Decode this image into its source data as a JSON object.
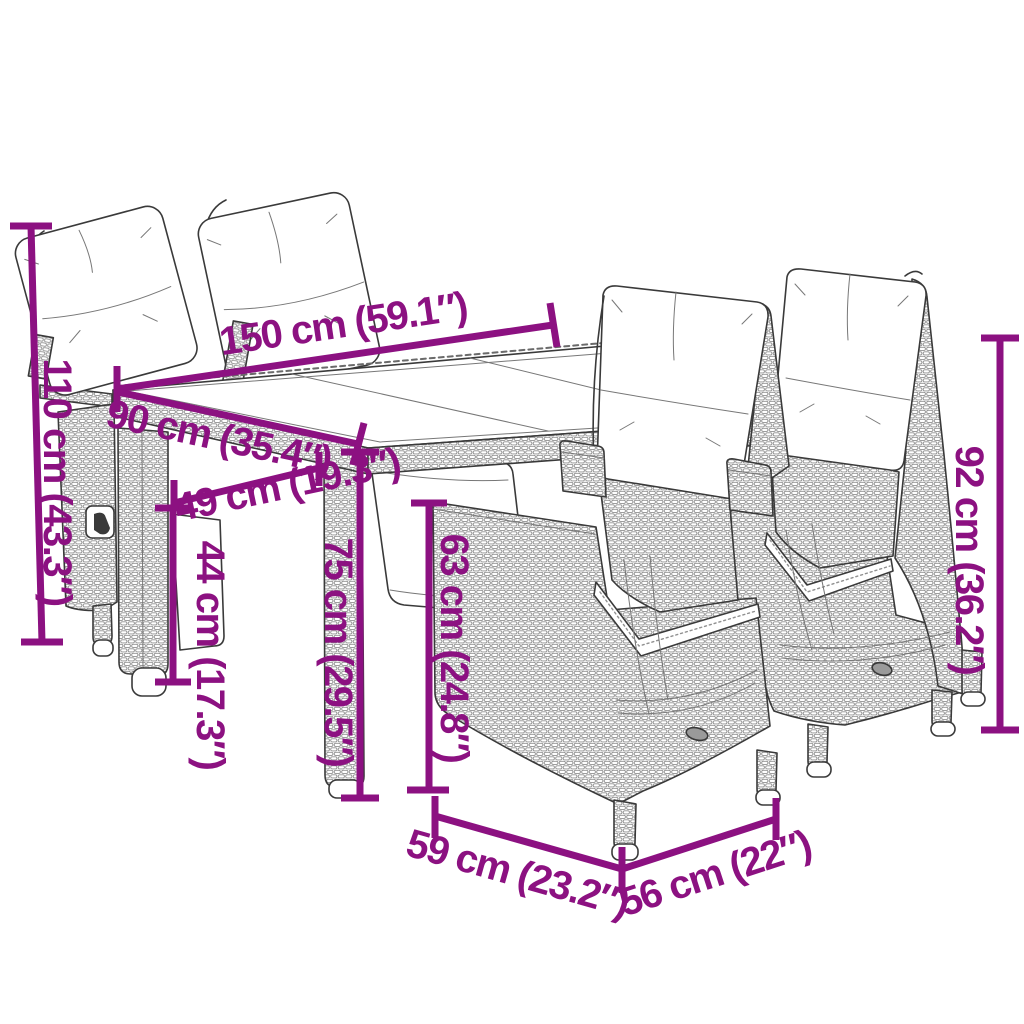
{
  "page": {
    "type": "product dimension diagram",
    "product": "5-piece garden dining set with cushions (poly rattan line drawing)"
  },
  "colors": {
    "accent": "#8C1181",
    "outline": "#3A3A3A",
    "texture": "#8F8F8F",
    "cushion": "#FFFFFF",
    "background": "#FFFFFF"
  },
  "furniture": {
    "table": "glass-top rattan dining table",
    "chair_back_left": "reclining rattan chair with back cushion",
    "chair_back_mid": "reclining rattan chair with back cushion",
    "chair_front": "reclining rattan chair with cushions",
    "chair_right": "reclining rattan chair with cushions"
  },
  "dimensions": {
    "table_length": {
      "label": "150 cm (59.1″)",
      "cm": 150,
      "inches": 59.1
    },
    "table_width": {
      "label": "90 cm (35.4″)",
      "cm": 90,
      "inches": 35.4
    },
    "back_chair_height": {
      "label": "110 cm (43.3″)",
      "cm": 110,
      "inches": 43.3
    },
    "seat_depth": {
      "label": "49 cm (19.3″)",
      "cm": 49,
      "inches": 19.3
    },
    "seat_height": {
      "label": "44 cm (17.3″)",
      "cm": 44,
      "inches": 17.3
    },
    "table_height": {
      "label": "75 cm (29.5″)",
      "cm": 75,
      "inches": 29.5
    },
    "side_panel_height": {
      "label": "63 cm (24.8″)",
      "cm": 63,
      "inches": 24.8
    },
    "front_chair_back_height": {
      "label": "92 cm (36.2″)",
      "cm": 92,
      "inches": 36.2
    },
    "chair_width": {
      "label": "59 cm (23.2″)",
      "cm": 59,
      "inches": 23.2
    },
    "chair_depth": {
      "label": "56 cm (22″)",
      "cm": 56,
      "inches": 22
    }
  }
}
